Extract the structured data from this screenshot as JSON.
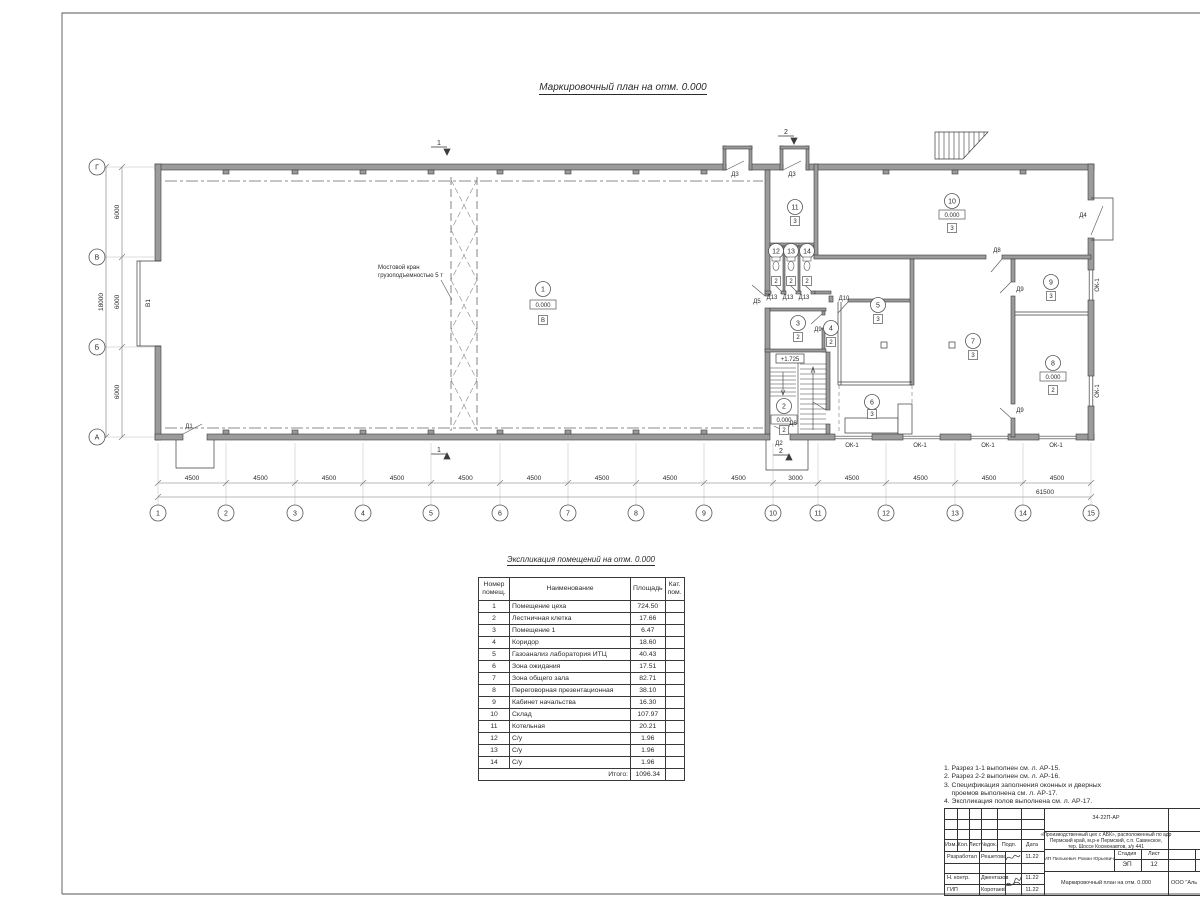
{
  "plan": {
    "title": "Маркировочный план  на отм. 0.000",
    "crane_line1": "Мостовой кран",
    "crane_line2": "грузоподъемностью 5 т",
    "gate_label": "В1",
    "window_label": "ОК-1",
    "stair_level": "+1.725",
    "section1": "1",
    "section2": "2",
    "row_axes": [
      "Г",
      "В",
      "Б",
      "А"
    ],
    "col_axes": [
      "1",
      "2",
      "3",
      "4",
      "5",
      "6",
      "7",
      "8",
      "9",
      "10",
      "11",
      "12",
      "13",
      "14",
      "15"
    ],
    "dims_bottom": [
      "4500",
      "4500",
      "4500",
      "4500",
      "4500",
      "4500",
      "4500",
      "4500",
      "4500",
      "3000",
      "4500",
      "4500",
      "4500",
      "4500"
    ],
    "dim_total": "61500",
    "dims_left": [
      "6000",
      "6000",
      "6000"
    ],
    "dim_left_total": "18000",
    "doors": {
      "d1": "Д1",
      "d2": "Д2",
      "d3": "Д3",
      "d4": "Д4",
      "d5": "Д5",
      "d6": "Д6",
      "d8": "Д8",
      "d9": "Д9",
      "d10": "Д10",
      "d13": "Д13"
    },
    "rooms": [
      {
        "num": "1",
        "level": "0.000",
        "cat": "В"
      },
      {
        "num": "2",
        "level": "0.000",
        "cat": "2"
      },
      {
        "num": "3",
        "cat": "2"
      },
      {
        "num": "4",
        "cat": "2"
      },
      {
        "num": "5",
        "cat": "3"
      },
      {
        "num": "6",
        "cat": "3"
      },
      {
        "num": "7",
        "cat": "3"
      },
      {
        "num": "8",
        "level": "0.000",
        "cat": "2"
      },
      {
        "num": "9",
        "cat": "3"
      },
      {
        "num": "10",
        "level": "0.000",
        "cat": "3"
      },
      {
        "num": "11",
        "cat": "3"
      },
      {
        "num": "12",
        "cat": "2"
      },
      {
        "num": "13",
        "cat": "2"
      },
      {
        "num": "14",
        "cat": "2"
      }
    ]
  },
  "table": {
    "title": "Экспликация помещений на отм. 0.000",
    "headers": {
      "num": "Номер помещ.",
      "name": "Наименование",
      "area": "Площадь",
      "cat": "Кат. пом."
    },
    "rows": [
      [
        "1",
        "Помещение цеха",
        "724.50"
      ],
      [
        "2",
        "Лестничная клетка",
        "17.66"
      ],
      [
        "3",
        "Помещение 1",
        "6.47"
      ],
      [
        "4",
        "Коридор",
        "18.60"
      ],
      [
        "5",
        "Газоанализ лаборатория ИТЦ",
        "40.43"
      ],
      [
        "6",
        "Зона ожидания",
        "17.51"
      ],
      [
        "7",
        "Зона общего зала",
        "82.71"
      ],
      [
        "8",
        "Переговорная презентационная",
        "38.10"
      ],
      [
        "9",
        "Кабинет начальства",
        "16.30"
      ],
      [
        "10",
        "Склад",
        "107.97"
      ],
      [
        "11",
        "Котельная",
        "20.21"
      ],
      [
        "12",
        "С/у",
        "1.96"
      ],
      [
        "13",
        "С/у",
        "1.96"
      ],
      [
        "14",
        "С/у",
        "1.96"
      ]
    ],
    "total_label": "Итого:",
    "total_value": "1096.34"
  },
  "notes": {
    "lines": [
      "1. Разрез 1-1 выполнен см. л. АР-15.",
      "2. Разрез 2-2 выполнен см. л. АР-16.",
      "3. Спецификация заполнения оконных и дверных",
      "    проемов выполнена см. л. АР-17.",
      "4. Экспликация полов выполнена см. л. АР-17."
    ]
  },
  "stamp": {
    "code": "34-22П-АР",
    "desc1": "«Производственный цех с АБК», расположенный по адр",
    "desc2": "Пермский край, м.р-н Пермский, с.п. Савинское,",
    "desc3": "тер. Шоссе Космонавтов, з/у 441",
    "customer": "ИП Пилькевич Роман Юрьевич",
    "doc_title": "Маркировочный план на отм. 0.000",
    "org": "ООО \"Аль",
    "stage_label": "Стадия",
    "sheet_label": "Лист",
    "stage": "ЭП",
    "sheet": "12",
    "cols": [
      "Изм.",
      "Кол.",
      "Лист",
      "№док.",
      "Подп.",
      "Дата"
    ],
    "roles": [
      {
        "role": "Разработал",
        "name": "Решетова",
        "date": "11.22"
      },
      {
        "role": "Н. контр.",
        "name": "Джентазов",
        "date": "11.22"
      },
      {
        "role": "ГИП",
        "name": "Коротаев",
        "date": "11.22"
      }
    ]
  }
}
